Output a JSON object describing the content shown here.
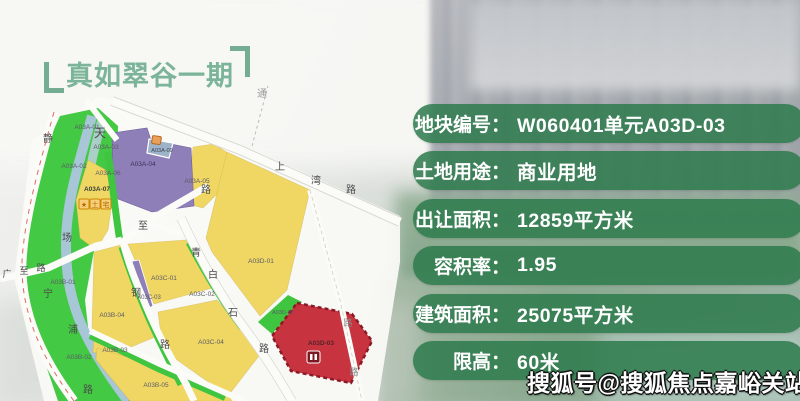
{
  "page": {
    "title": "真如翠谷一期",
    "watermark": "搜狐号@搜狐焦点嘉峪关站"
  },
  "info_panel": {
    "rows": [
      {
        "label": "地块编号：",
        "value": "W060401单元A03D-03"
      },
      {
        "label": "土地用途：",
        "value": "商业用地"
      },
      {
        "label": "出让面积：",
        "value": "12859平方米"
      },
      {
        "label": "容积率：",
        "value": "1.95"
      },
      {
        "label": "建筑面积：",
        "value": "25075平方米"
      },
      {
        "label": "限高：",
        "value": "60米"
      }
    ]
  },
  "colors": {
    "panel_green": "#2d7a4c",
    "title_green": "#7cb49a",
    "parcel_yellow": "#f0d763",
    "parcel_purple": "#8f7fb8",
    "parcel_red": "#c7333f",
    "park_green": "#44c944",
    "river_blue": "#a7c6d6"
  },
  "map": {
    "road_chars": [
      {
        "t": "通",
        "x": 262,
        "y": 97,
        "c": "#9a9a9a",
        "s": 10
      },
      {
        "t": "静",
        "x": 48,
        "y": 142,
        "s": 10
      },
      {
        "t": "宁",
        "x": 48,
        "y": 297,
        "s": 10
      },
      {
        "t": "路",
        "x": 88,
        "y": 393,
        "s": 10
      },
      {
        "t": "广",
        "x": 7,
        "y": 277,
        "s": 9
      },
      {
        "t": "至",
        "x": 24,
        "y": 274,
        "s": 9
      },
      {
        "t": "路",
        "x": 41,
        "y": 271,
        "s": 9
      },
      {
        "t": "场",
        "x": 67,
        "y": 241,
        "s": 10
      },
      {
        "t": "浦",
        "x": 73,
        "y": 333,
        "s": 10
      },
      {
        "t": "天",
        "x": 100,
        "y": 137,
        "s": 12
      },
      {
        "t": "至",
        "x": 143,
        "y": 229,
        "s": 10
      },
      {
        "t": "钢",
        "x": 136,
        "y": 296,
        "s": 10
      },
      {
        "t": "路",
        "x": 165,
        "y": 348,
        "s": 10
      },
      {
        "t": "路",
        "x": 206,
        "y": 193,
        "s": 10
      },
      {
        "t": "青",
        "x": 196,
        "y": 256,
        "s": 10
      },
      {
        "t": "白",
        "x": 213,
        "y": 278,
        "s": 10
      },
      {
        "t": "石",
        "x": 233,
        "y": 316,
        "s": 10
      },
      {
        "t": "路",
        "x": 264,
        "y": 352,
        "s": 10
      },
      {
        "t": "上",
        "x": 280,
        "y": 170,
        "s": 10
      },
      {
        "t": "湾",
        "x": 316,
        "y": 184,
        "s": 10
      },
      {
        "t": "路",
        "x": 351,
        "y": 193,
        "s": 10
      },
      {
        "t": "路",
        "x": 348,
        "y": 326,
        "c": "#8a8a8a",
        "s": 9
      },
      {
        "t": "路",
        "x": 354,
        "y": 375,
        "c": "#8a8a8a",
        "s": 9
      }
    ],
    "parcel_labels": [
      {
        "t": "A03A-01",
        "x": 87,
        "y": 129
      },
      {
        "t": "A03A-03",
        "x": 106,
        "y": 149
      },
      {
        "t": "A03A-02",
        "x": 74,
        "y": 168
      },
      {
        "t": "A03A-06",
        "x": 108,
        "y": 175
      },
      {
        "t": "A03A-04",
        "x": 143,
        "y": 166,
        "c": "#38305a"
      },
      {
        "t": "A03A-09",
        "x": 162,
        "y": 152,
        "s": 5.5,
        "c": "#3c4452"
      },
      {
        "t": "A03A-05",
        "x": 197,
        "y": 183
      },
      {
        "t": "A03A-07",
        "x": 97,
        "y": 191,
        "c": "#39423a",
        "w": 700
      },
      {
        "t": "A03B-01",
        "x": 63,
        "y": 284
      },
      {
        "t": "A03B-04",
        "x": 112,
        "y": 317
      },
      {
        "t": "A03B-02",
        "x": 79,
        "y": 359
      },
      {
        "t": "A03B-03",
        "x": 115,
        "y": 352
      },
      {
        "t": "A03B-05",
        "x": 156,
        "y": 387
      },
      {
        "t": "A03C-01",
        "x": 164,
        "y": 280
      },
      {
        "t": "A03C-03",
        "x": 149,
        "y": 299,
        "s": 6
      },
      {
        "t": "A03C-02",
        "x": 202,
        "y": 296
      },
      {
        "t": "A03C-04",
        "x": 211,
        "y": 344
      },
      {
        "t": "A03D-01",
        "x": 261,
        "y": 263
      },
      {
        "t": "A03D-02",
        "x": 283,
        "y": 314,
        "s": 5.5
      },
      {
        "t": "A03D-03",
        "x": 321,
        "y": 345,
        "c": "#57242b",
        "w": 700
      }
    ],
    "badge_chars": [
      "★",
      "土",
      "宅"
    ]
  }
}
